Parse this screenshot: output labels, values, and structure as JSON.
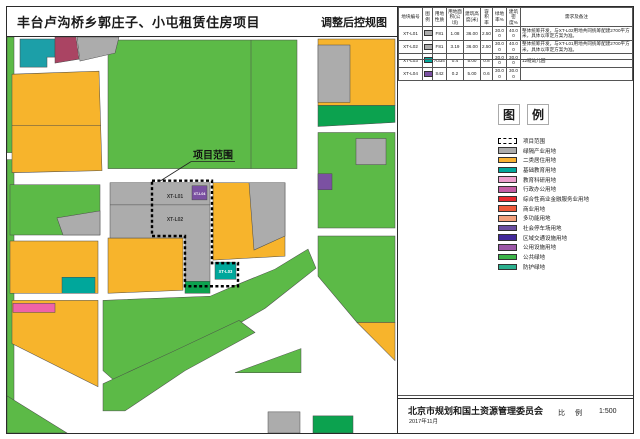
{
  "title": "丰台卢沟桥乡郭庄子、小屯租赁住房项目",
  "subtitle": "调整后控规图",
  "table": {
    "headers": [
      "地块编号",
      "图例",
      "用地性质",
      "用地面积(公顷)",
      "建筑高度(米)",
      "容积率",
      "绿地率%",
      "建筑密度%",
      "需求及备注"
    ],
    "rows": [
      {
        "code": "XT-L01",
        "chip_color": "#ACACAC",
        "nature": "F81",
        "area": "1.08",
        "height": "36.00",
        "far": "2.50",
        "green": "30.00",
        "density": "40.00",
        "remark": "整体统筹开发，与XT-L02用地共同统筹配建2700平方米，具体以审定方案为准。"
      },
      {
        "code": "XT-L02",
        "chip_color": "#ACACAC",
        "nature": "F81",
        "area": "3.19",
        "height": "36.00",
        "far": "2.50",
        "green": "30.00",
        "density": "40.00",
        "remark": "整体统筹开发，与XT-L01用地共同统筹配建2700平方米，具体以审定方案为准。"
      },
      {
        "code": "XT-L03",
        "chip_color": "#00A79B",
        "nature": "A334",
        "area": "0.4",
        "height": "5.00",
        "far": "0.8",
        "green": "30.00",
        "density": "30.00",
        "remark": "12班幼儿园"
      },
      {
        "code": "XT-L04",
        "chip_color": "#7B51A2",
        "nature": "S42",
        "area": "0.2",
        "height": "5.00",
        "far": "0.6",
        "green": "30.00",
        "density": "30.00",
        "remark": ""
      }
    ]
  },
  "legend": {
    "heading_char1": "图",
    "heading_char2": "例",
    "items": [
      {
        "label": "项目范围",
        "color": "#FFFFFF",
        "dashed": true
      },
      {
        "label": "绿隔产业用地",
        "color": "#ACACAC"
      },
      {
        "label": "二类居住用地",
        "color": "#F9B233"
      },
      {
        "label": "基础教育用地",
        "color": "#00A79B"
      },
      {
        "label": "教育科研用地",
        "color": "#EC9ECD"
      },
      {
        "label": "行政办公用地",
        "color": "#C35CA4"
      },
      {
        "label": "综合性商业金融服务业用地",
        "color": "#E8282E"
      },
      {
        "label": "商业用地",
        "color": "#EF5A3A"
      },
      {
        "label": "多功能用地",
        "color": "#F3A07B"
      },
      {
        "label": "社会停车场用地",
        "color": "#6A4EA0"
      },
      {
        "label": "区域交通设施用地",
        "color": "#42299A"
      },
      {
        "label": "公用设施用地",
        "color": "#9C58A8"
      },
      {
        "label": "公共绿地",
        "color": "#3BB449"
      },
      {
        "label": "防护绿地",
        "color": "#2BB08E"
      }
    ]
  },
  "map": {
    "boundary_label": "项目范围",
    "parcel_l01": "XT-L01",
    "parcel_l02": "XT-L02",
    "parcel_l03": "XT-L03",
    "parcel_l04": "XT-L04"
  },
  "footer": {
    "agency": "北京市规划和国土资源管理委员会",
    "date": "2017年11月",
    "scale_label": "比 例",
    "scale_value": "1:500"
  },
  "colors": {
    "map_green": "#5CBA47",
    "map_dark_green": "#0CA24F",
    "map_yellow": "#F7B42C",
    "map_gray": "#ACACAC",
    "map_teal": "#00A79B",
    "map_purple": "#7B51A2",
    "map_pink": "#EF63A8",
    "map_maroon": "#AA4463",
    "road_white": "#FFFFFF"
  }
}
